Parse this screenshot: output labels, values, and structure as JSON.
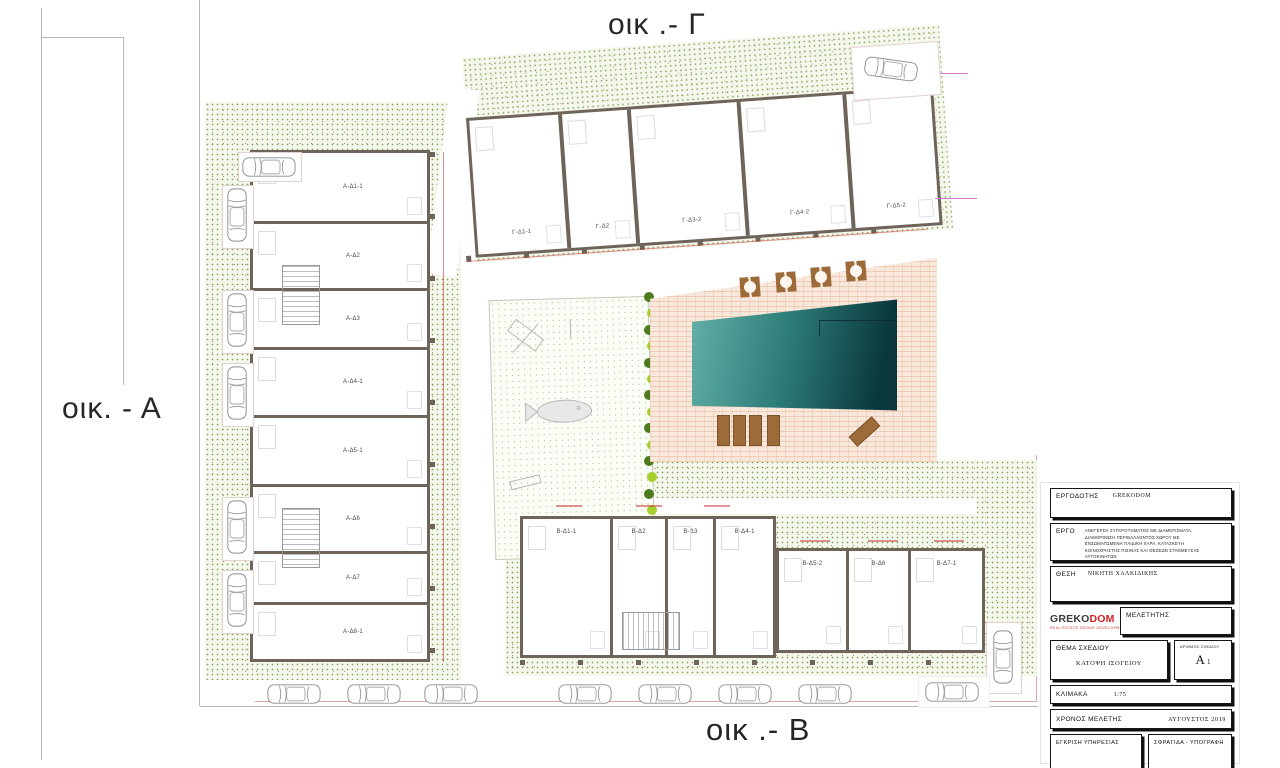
{
  "blocks": {
    "gamma_label": "οικ .- Γ",
    "alpha_label": "οικ. - Α",
    "beta_label": "οικ .- Β"
  },
  "buildings": {
    "alpha_units": [
      "Α-Δ1-1",
      "Α-Δ2",
      "Α-Δ3",
      "Α-Δ4-1",
      "Α-Δ5-1",
      "Α-Δ6",
      "Α-Δ7",
      "Α-Δ8-1"
    ],
    "gamma_units": [
      "Γ-Δ1-1",
      "Γ-Δ2",
      "Γ-Δ3-2",
      "Γ-Δ4-2",
      "Γ-Δ5-2"
    ],
    "beta_left_units": [
      "Β-Δ1-1",
      "Β-Δ2",
      "Β-Δ3",
      "Β-Δ4-1"
    ],
    "beta_right_units": [
      "Β-Δ5-2",
      "Β-Δ6",
      "Β-Δ7-1"
    ]
  },
  "title_block": {
    "client_label": "ΕΡΓΟΔΟΤΗΣ",
    "client_value": "GREKODOM",
    "project_label": "ΕΡΓΟ",
    "project_value": "ΑΝΕΓΕΡΣΗ ΣΥΓΚΡΟΤΗΜΑΤΟΣ ΜΕ ΔΙΑΜΕΡΙΣΜΑΤΑ, ΔΙΑΜΟΡΦΩΣΗ ΠΕΡΙΒΑΛΛΟΝΤΟΣ ΧΩΡΟΥ ΜΕ ΕΝΣΩΜΑΤΩΜΕΝΗ ΠΑΙΔΙΚΗ ΧΑΡΑ, ΚΑΤΑΣΚΕΥΗ ΚΟΙΝΟΧΡΗΣΤΗΣ ΠΙΣΙΝΑΣ ΚΑΙ ΘΕΣΕΩΝ ΣΤΑΘΜΕΥΣΗΣ ΑΥΤΟΚΙΝΗΤΩΝ",
    "location_label": "ΘΕΣΗ",
    "location_value": "ΝΙΚΗΤΗ ΧΑΛΚΙΔΙΚΗΣ",
    "designer_label": "ΜΕΛΕΤΗΤΗΣ",
    "logo_part1": "GREKO",
    "logo_part2": "DOM",
    "logo_tagline": "REAL ESTATE GROUP DEVELOPMENT",
    "drawing_title_label": "ΘΕΜΑ ΣΧΕΔΙΟΥ",
    "drawing_title_value": "ΚΑΤΟΨΗ ΙΣΟΓΕΙΟΥ",
    "drawing_no_label": "ΑΡΙΘΜΟΣ ΣΧΕΔΙΟΥ",
    "drawing_no_letter": "Α",
    "drawing_no_number": "1",
    "scale_label": "ΚΛΙΜΑΚΑ",
    "scale_value": "1:75",
    "date_label": "ΧΡΟΝΟΣ ΜΕΛΕΤΗΣ",
    "date_value": "ΑΥΓΟΥΣΤΟΣ 2019",
    "approval_label": "ΕΓΚΡΙΣΗ ΥΠΗΡΕΣΙΑΣ",
    "stamp_label": "ΣΦΡΑΓΙΔΑ - ΥΠΟΓΡΑΦΗ"
  },
  "colors": {
    "wall": "#6e6459",
    "pool_light": "#63b0a8",
    "pool_dark": "#0a383c",
    "deck": "#f8e8db",
    "hatch_dot": "#87a158",
    "tree_lime": "#a6cf2e",
    "tree_dark": "#4d7a1d",
    "furniture_brown": "#9d6b3a",
    "brand_red": "#d42027",
    "dimension_magenta": "#cf7ad1",
    "dimension_red": "#c83232"
  }
}
